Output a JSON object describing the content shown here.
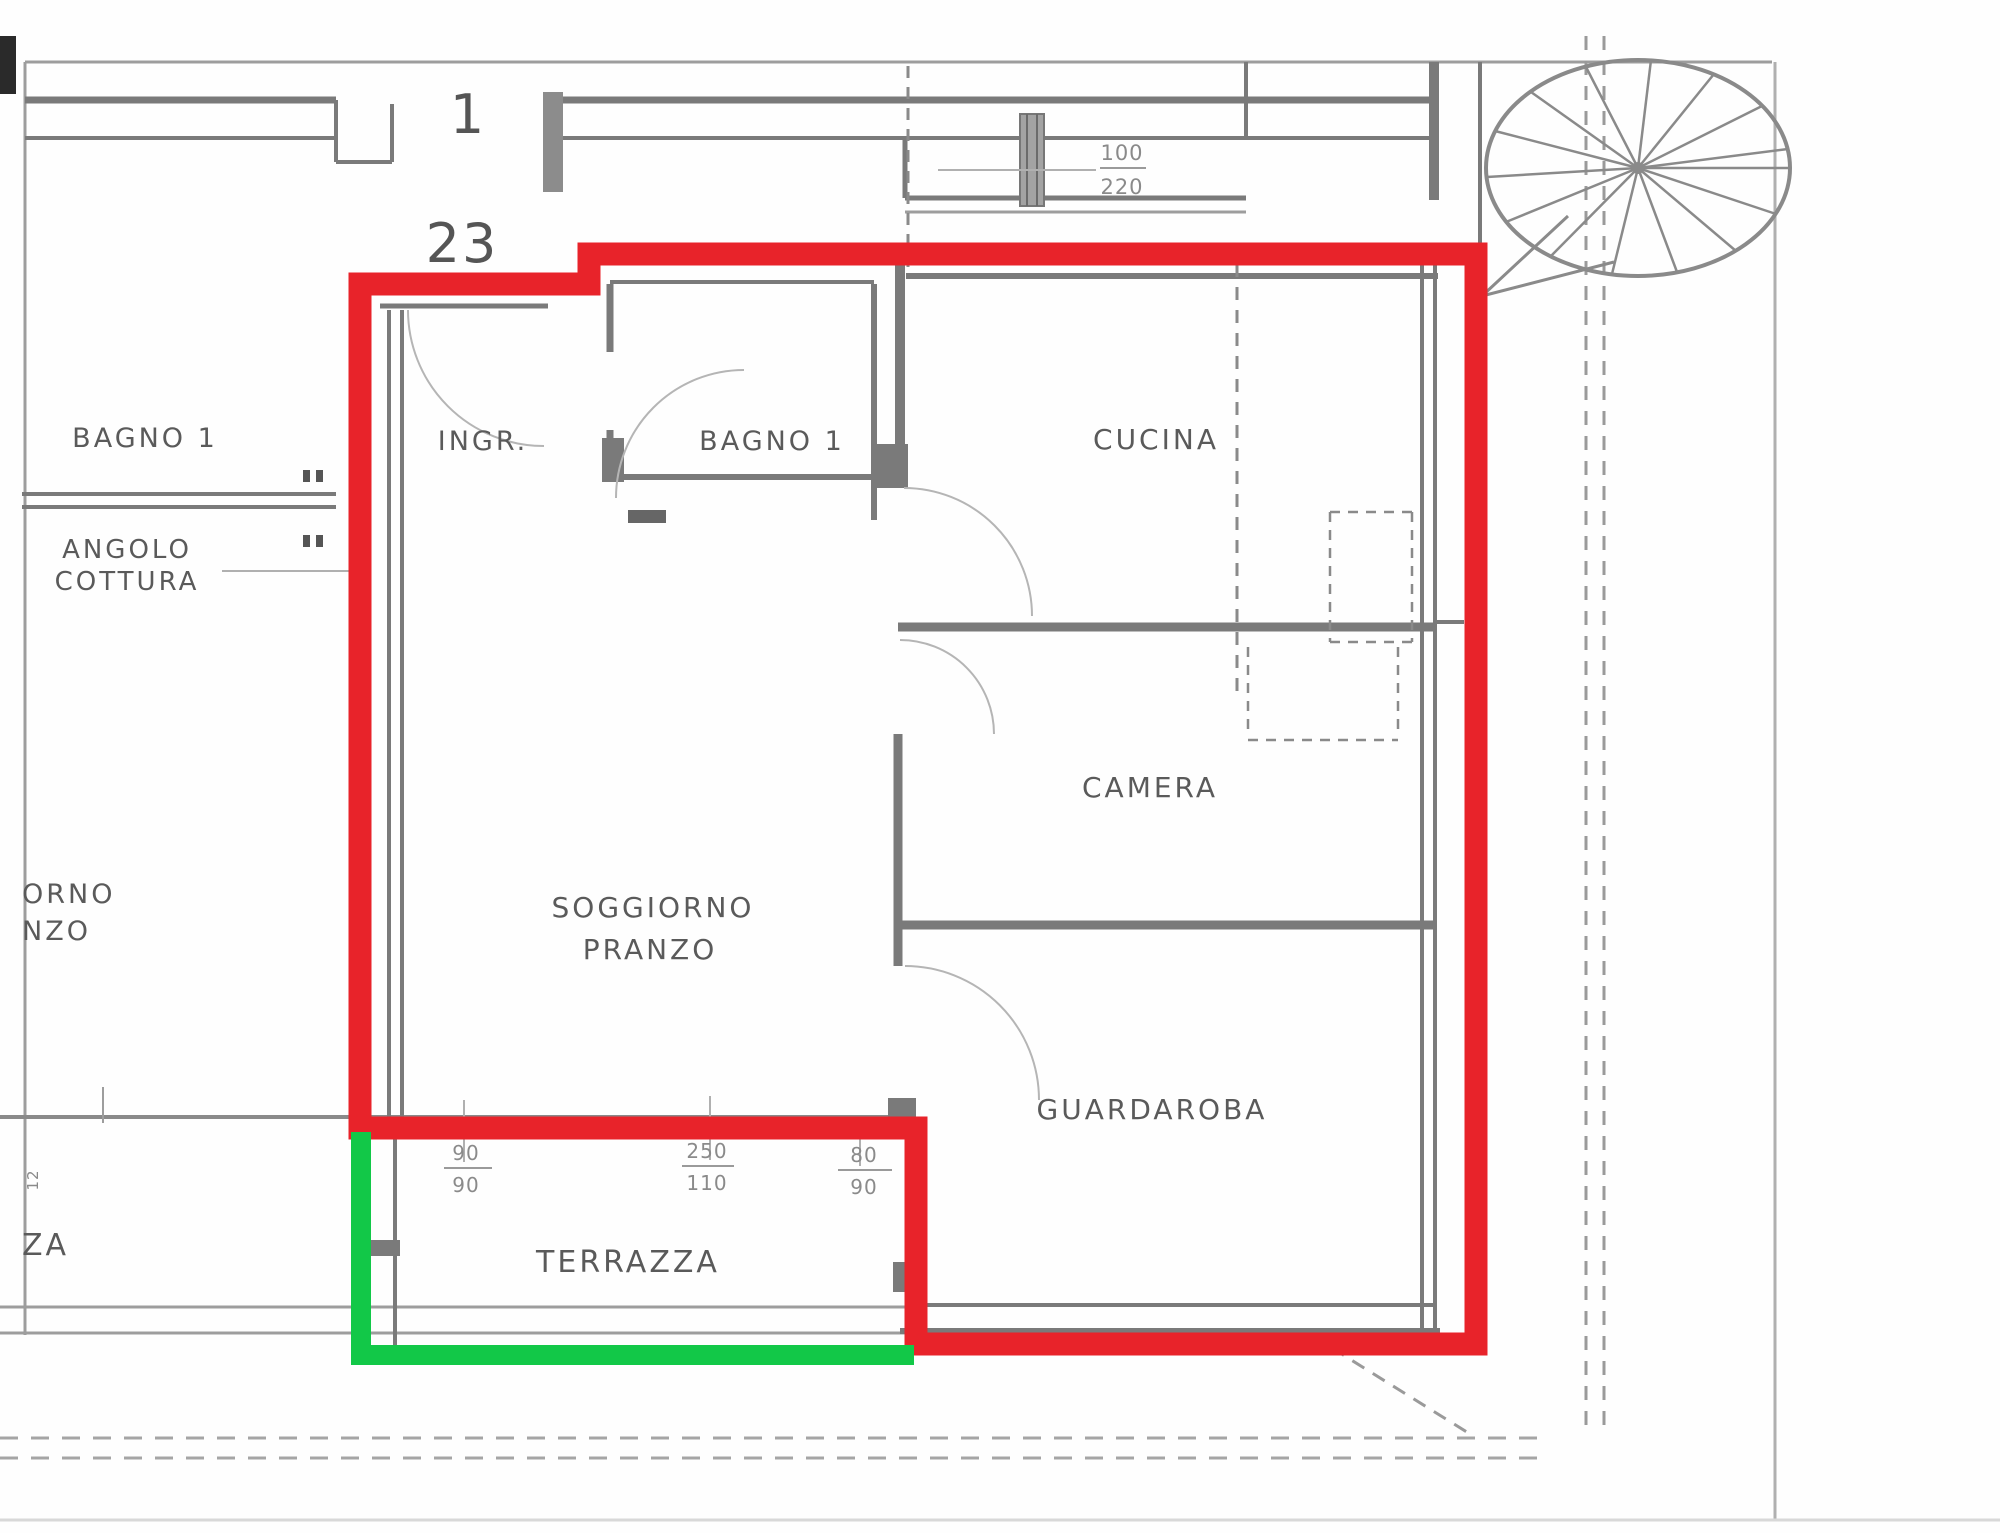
{
  "plan": {
    "title_context": "floor plan",
    "unit_numbers": {
      "building": "1",
      "apartment": "23"
    },
    "rooms": {
      "ingresso": "INGR.",
      "bagno_inner": "BAGNO 1",
      "cucina": "CUCINA",
      "camera": "CAMERA",
      "soggiorno_line1": "SOGGIORNO",
      "soggiorno_line2": "PRANZO",
      "guardaroba": "GUARDAROBA",
      "terrazza": "TERRAZZA"
    },
    "neighbor_labels": {
      "bagno_left": "BAGNO 1",
      "angolo_line1": "ANGOLO",
      "angolo_line2": "COTTURA",
      "soggiorno_cut_line1": "ORNO",
      "soggiorno_cut_line2": "NZO",
      "terrazza_cut": "ZA",
      "side_dim": "12"
    },
    "dimensions": {
      "entrance": {
        "top": "100",
        "bottom": "220"
      },
      "terrace_left": {
        "top": "90",
        "bottom": "90"
      },
      "terrace_mid": {
        "top": "250",
        "bottom": "110"
      },
      "terrace_right": {
        "top": "80",
        "bottom": "90"
      }
    },
    "annotations": {
      "red_outline_color": "#e8232a",
      "green_outline_color": "#12c848",
      "wall_color": "#7a7a7a",
      "thin_line_color": "#9d9d9d"
    }
  }
}
